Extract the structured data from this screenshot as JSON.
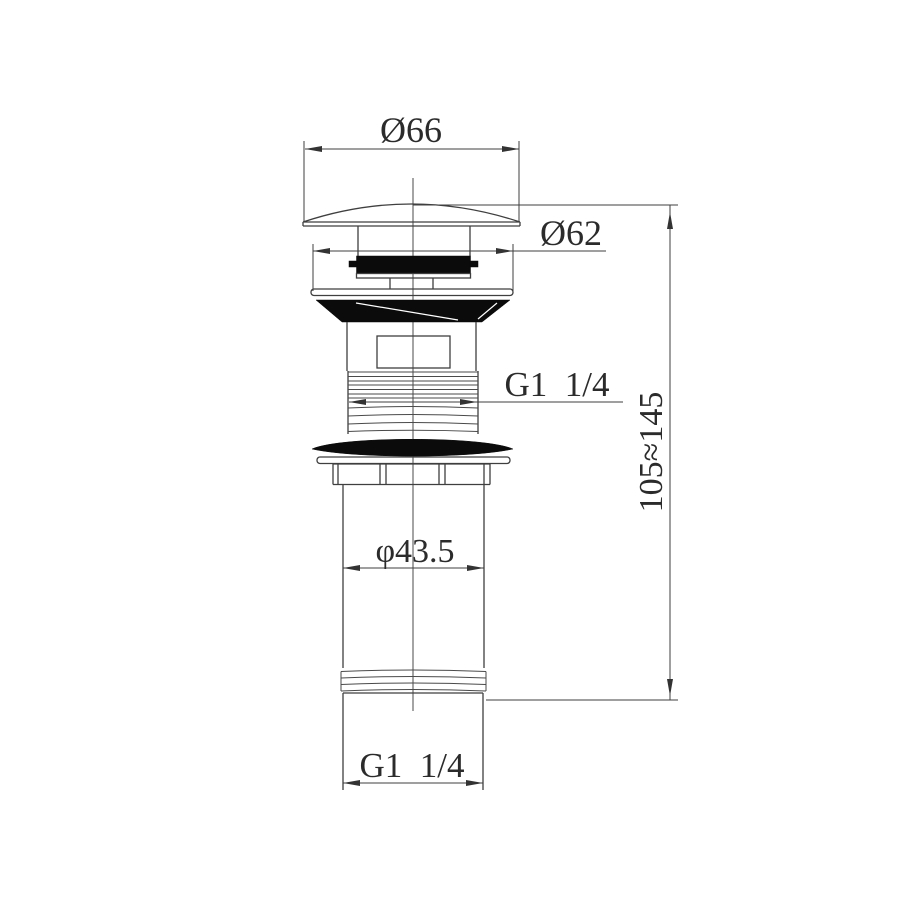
{
  "drawing": {
    "subject": "basin pop-up waste drain technical drawing",
    "background_color": "#ffffff",
    "line_color": "#3f3f3f",
    "fill_color": "#0b0b0b",
    "dimensions": {
      "cap_diameter": "Ø66",
      "cover_diameter": "Ø62",
      "top_thread_spec": "G1  1/4",
      "pipe_diameter": "φ43.5",
      "height_range": "105≈145",
      "bottom_thread_spec": "G1  1/4"
    }
  }
}
